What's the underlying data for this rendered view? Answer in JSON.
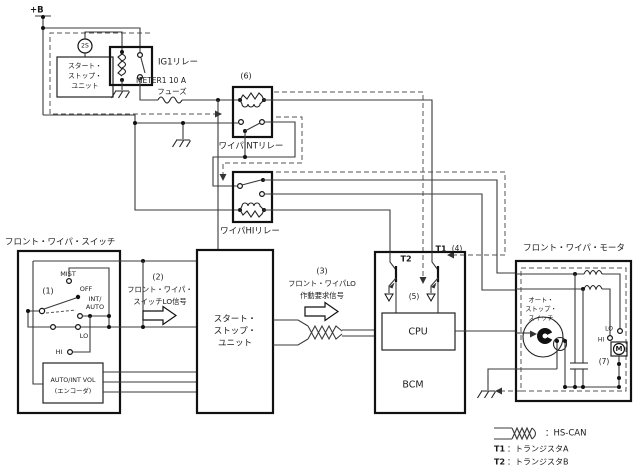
{
  "power": {
    "label": "+B"
  },
  "top_left": {
    "connector": "2S",
    "unit": [
      "スタート・",
      "ストップ・",
      "ユニット"
    ],
    "relay": "IG1リレー",
    "fuse": [
      "METER1 10 A",
      "フューズ"
    ]
  },
  "relays": {
    "step6": "(6)",
    "int_relay": "ワイパINTリレー",
    "hi_relay": "ワイパHIリレー"
  },
  "wiper_switch": {
    "title": "フロント・ワイパ・スイッチ",
    "step1": "(1)",
    "positions": {
      "mist": "MIST",
      "off": "OFF",
      "int_auto": [
        "INT/",
        "AUTO"
      ],
      "lo": "LO",
      "hi": "HI"
    },
    "encoder": [
      "AUTO/INT VOL",
      "(エンコーダ)"
    ]
  },
  "signal2": {
    "step": "(2)",
    "lines": [
      "フロント・ワイパ・",
      "スイッチLO信号"
    ]
  },
  "unit": {
    "lines": [
      "スタート・",
      "ストップ・",
      "ユニット"
    ]
  },
  "signal3": {
    "step": "(3)",
    "lines": [
      "フロント・ワイパLO",
      "作動要求信号"
    ]
  },
  "bcm": {
    "name": "BCM",
    "cpu": "CPU",
    "t1": "T1",
    "t2": "T2",
    "step4": "(4)",
    "step5": "(5)"
  },
  "motor": {
    "title": "フロント・ワイパ・モータ",
    "autostop": [
      "オート・",
      "ストップ・",
      "スイッチ"
    ],
    "lo": "LO",
    "hi": "HI",
    "m": "M",
    "step7": "(7)"
  },
  "legend": {
    "hscan": "：HS-CAN",
    "t1": "T1",
    "t1_desc": "：トランジスタA",
    "t2": "T2",
    "t2_desc": "：トランジスタB"
  },
  "colors": {
    "line": "#3a3a3a",
    "background": "#ffffff"
  }
}
